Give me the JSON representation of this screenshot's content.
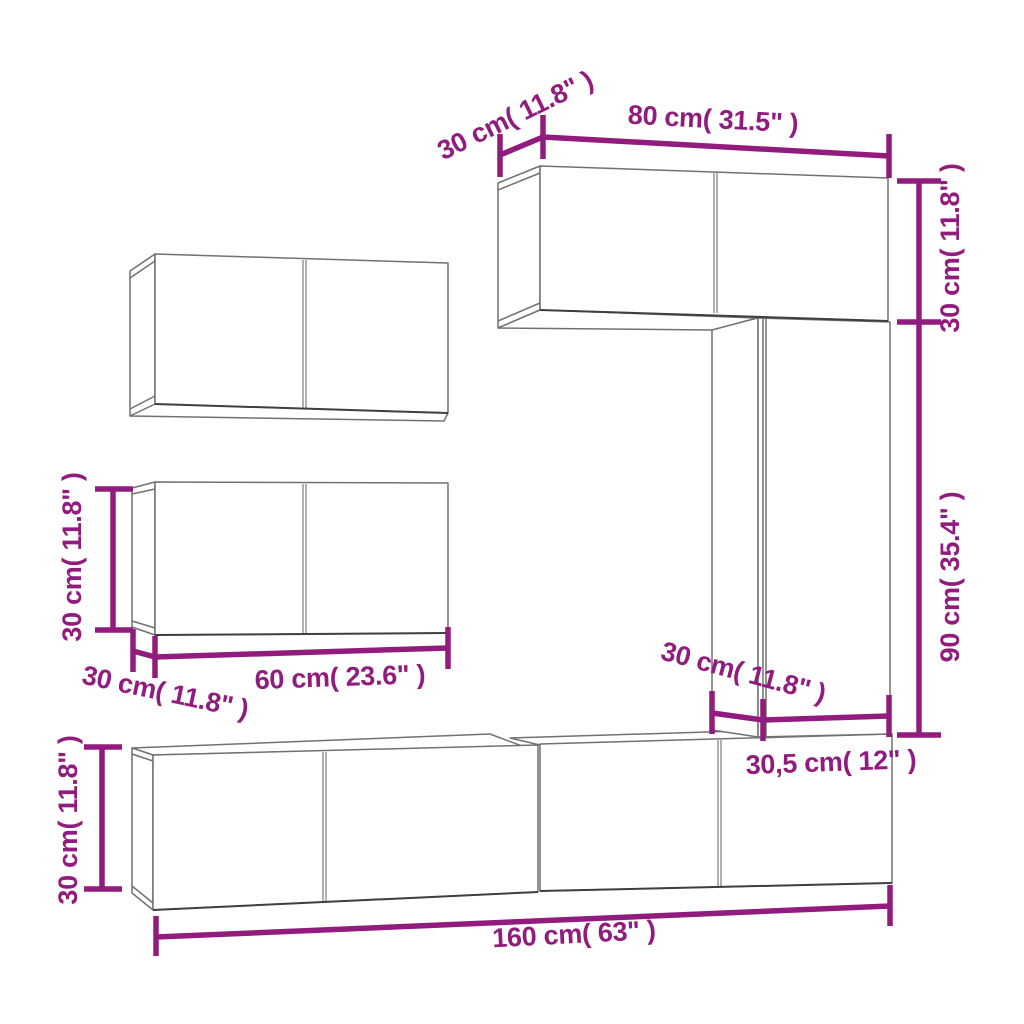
{
  "colors": {
    "dimension_purple": "#911C7E",
    "cabinet_outline_gray": "#717171",
    "cabinet_edge_dark": "#3F3F3F",
    "background": "#FFFFFF"
  },
  "labels": {
    "top_depth": "30 cm( 11.8\" )",
    "top_width": "80 cm( 31.5\" )",
    "right_upper_height": "30 cm( 11.8\" )",
    "right_lower_height": "90 cm( 35.4\" )",
    "mid_cabinet_height": "30 cm( 11.8\" )",
    "mid_cabinet_width": "60 cm( 23.6\" )",
    "mid_cabinet_depth": "30 cm( 11.8\" )",
    "column_depth": "30 cm( 11.8\" )",
    "column_width": "30,5 cm( 12\" )",
    "bottom_cabinet_height": "30 cm( 11.8\" )",
    "bottom_row_width": "160 cm( 63\" )"
  }
}
